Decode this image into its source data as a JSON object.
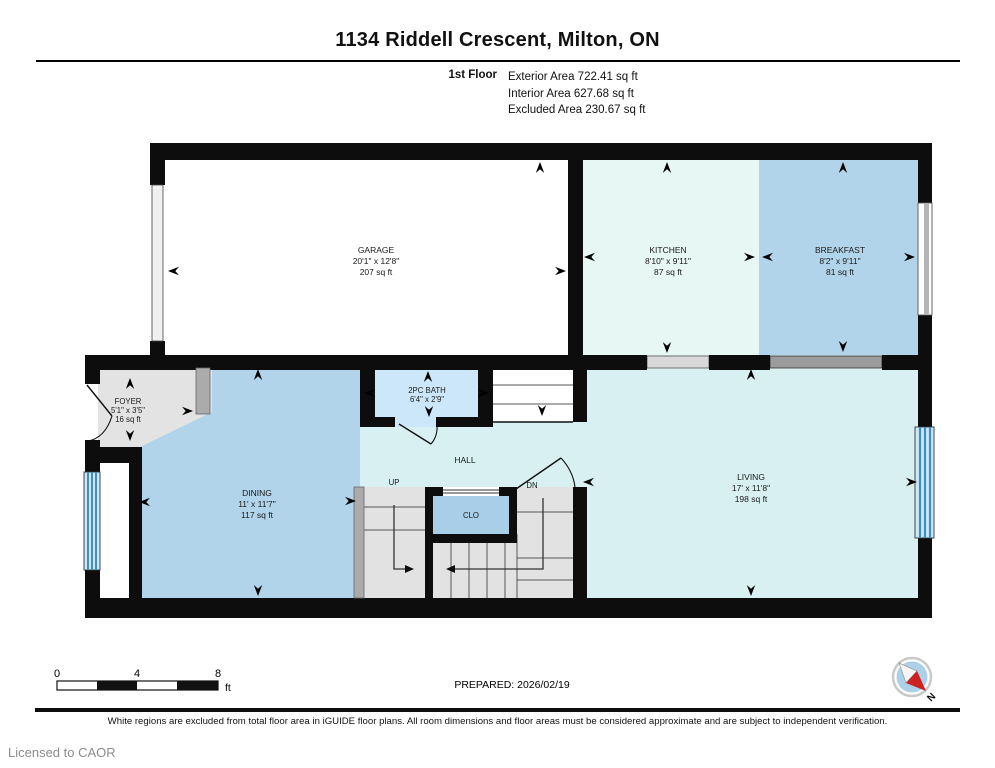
{
  "header": {
    "title": "1134 Riddell Crescent, Milton, ON",
    "floor_label": "1st Floor",
    "areas": {
      "exterior": "Exterior Area 722.41 sq ft",
      "interior": "Interior Area 627.68 sq ft",
      "excluded": "Excluded Area 230.67 sq ft"
    }
  },
  "rooms": {
    "garage": {
      "name": "GARAGE",
      "dims": "20'1\" x 12'8\"",
      "area": "207 sq ft"
    },
    "kitchen": {
      "name": "KITCHEN",
      "dims": "8'10\" x 9'11\"",
      "area": "87 sq ft"
    },
    "breakfast": {
      "name": "BREAKFAST",
      "dims": "8'2\" x 9'11\"",
      "area": "81 sq ft"
    },
    "foyer": {
      "name": "FOYER",
      "dims": "5'1\" x 3'5\"",
      "area": "16 sq ft"
    },
    "bath": {
      "name": "2PC BATH",
      "dims": "6'4\" x 2'9\""
    },
    "dining": {
      "name": "DINING",
      "dims": "11' x 11'7\"",
      "area": "117 sq ft"
    },
    "living": {
      "name": "LIVING",
      "dims": "17' x 11'8\"",
      "area": "198 sq ft"
    },
    "hall": {
      "name": "HALL"
    },
    "closet": {
      "name": "CLO"
    },
    "stair_up": "UP",
    "stair_down": "DN"
  },
  "scale_bar": {
    "tick0": "0",
    "tick1": "4",
    "tick2": "8",
    "unit": "ft"
  },
  "footer": {
    "prepared": "PREPARED: 2026/02/19",
    "compass_north": "N",
    "disclaimer": "White regions are excluded from total floor area in iGUIDE floor plans. All room dimensions and floor areas must be considered approximate and are subject to independent verification.",
    "license": "Licensed to CAOR"
  },
  "colors": {
    "wall": "#0d0d0d",
    "room_blue": "#b2d4ea",
    "room_mint": "#e7f7f3",
    "room_cyan": "#d8f0f1",
    "room_bath": "#cbe7f9",
    "room_gray": "#e3e3e3",
    "closet_blue": "#a9cee8",
    "window_blue": "#3f8fc4",
    "compass_red": "#cc2222"
  }
}
